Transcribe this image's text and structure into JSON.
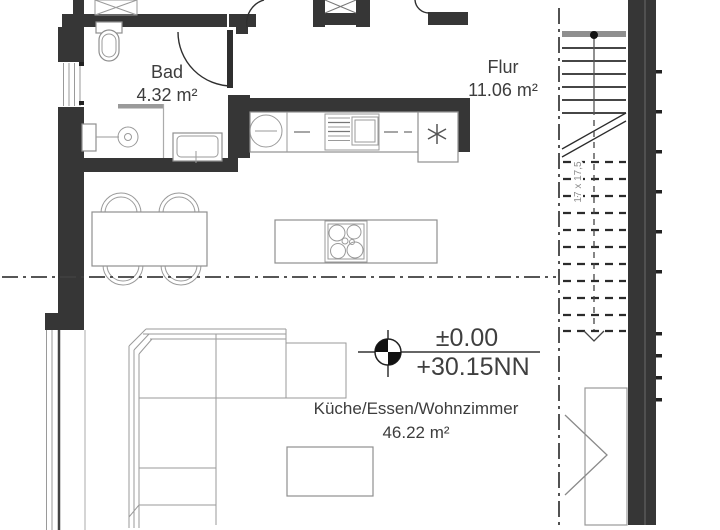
{
  "drawing": {
    "type": "architectural floor plan"
  },
  "rooms": [
    {
      "name": "Bad",
      "area": "4.32 m²"
    },
    {
      "name": "Flur",
      "area": "11.06 m²"
    },
    {
      "name": "Küche/Essen/Wohnzimmer",
      "area": "46.22 m²"
    }
  ],
  "elevation_marker": {
    "level": "±0.00",
    "datum": "+30.15NN"
  },
  "stairs": {
    "annotation": "17 x 17,5"
  },
  "colors": {
    "wall": "#363636",
    "furniture_line": "#9a9a9a",
    "text": "#3d3d3d",
    "background": "#ffffff"
  }
}
